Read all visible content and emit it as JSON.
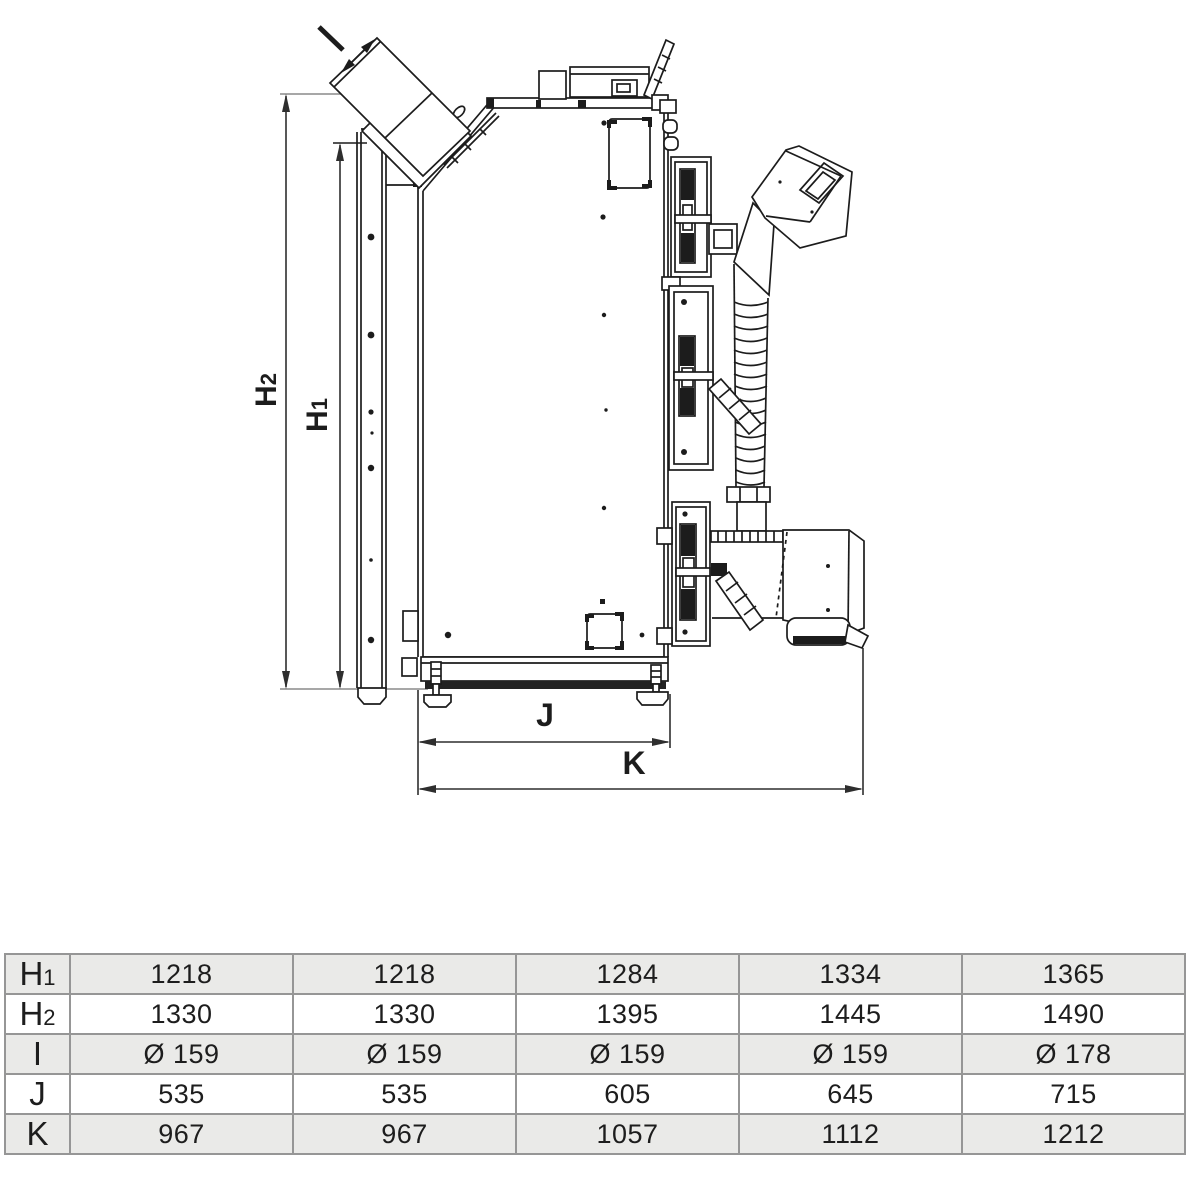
{
  "drawing": {
    "dims": {
      "h1": {
        "main": "H",
        "sub": "1"
      },
      "h2": {
        "main": "H",
        "sub": "2"
      },
      "j": "J",
      "k": "K"
    }
  },
  "table": {
    "row_labels": [
      {
        "main": "H",
        "sub": "1"
      },
      {
        "main": "H",
        "sub": "2"
      },
      {
        "main": "I",
        "sub": ""
      },
      {
        "main": "J",
        "sub": ""
      },
      {
        "main": "K",
        "sub": ""
      }
    ],
    "rows": [
      [
        "1218",
        "1218",
        "1284",
        "1334",
        "1365"
      ],
      [
        "1330",
        "1330",
        "1395",
        "1445",
        "1490"
      ],
      [
        "Ø 159",
        "Ø 159",
        "Ø 159",
        "Ø 159",
        "Ø 178"
      ],
      [
        "535",
        "535",
        "605",
        "645",
        "715"
      ],
      [
        "967",
        "967",
        "1057",
        "1112",
        "1212"
      ]
    ]
  },
  "colors": {
    "line": "#1c1c1c",
    "dimension_line": "#2e2e2e",
    "extension_line": "#8a8a8a",
    "table_border": "#969696",
    "row_shaded": "#eaeae8",
    "row_plain": "#ffffff"
  }
}
